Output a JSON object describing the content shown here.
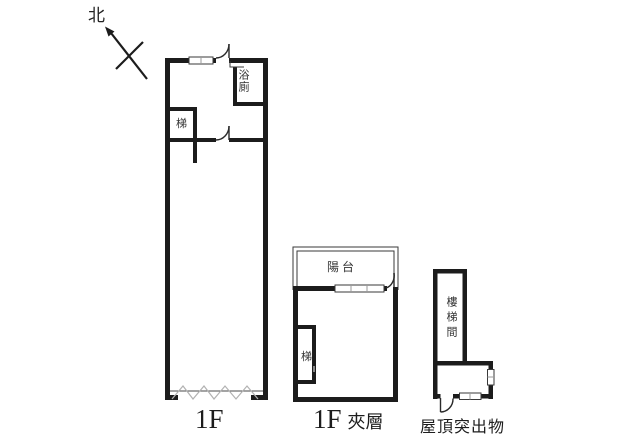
{
  "compass": {
    "north_label": "北"
  },
  "plan_1f": {
    "label": "1F",
    "stair_label": "梯",
    "bath_label": "浴廁"
  },
  "plan_mezzanine": {
    "label_prefix": "1F",
    "label_suffix": "夾層",
    "balcony_label": "陽台",
    "stair_label": "梯"
  },
  "plan_roof": {
    "label": "屋頂突出物",
    "stairwell_label": "樓梯間"
  },
  "colors": {
    "wall": "#1c1c1c",
    "thin_line": "#3a3a3a",
    "window_tick": "#999999",
    "entry_zigzag": "#b2b2b2",
    "text": "#222222",
    "background": "#ffffff"
  }
}
